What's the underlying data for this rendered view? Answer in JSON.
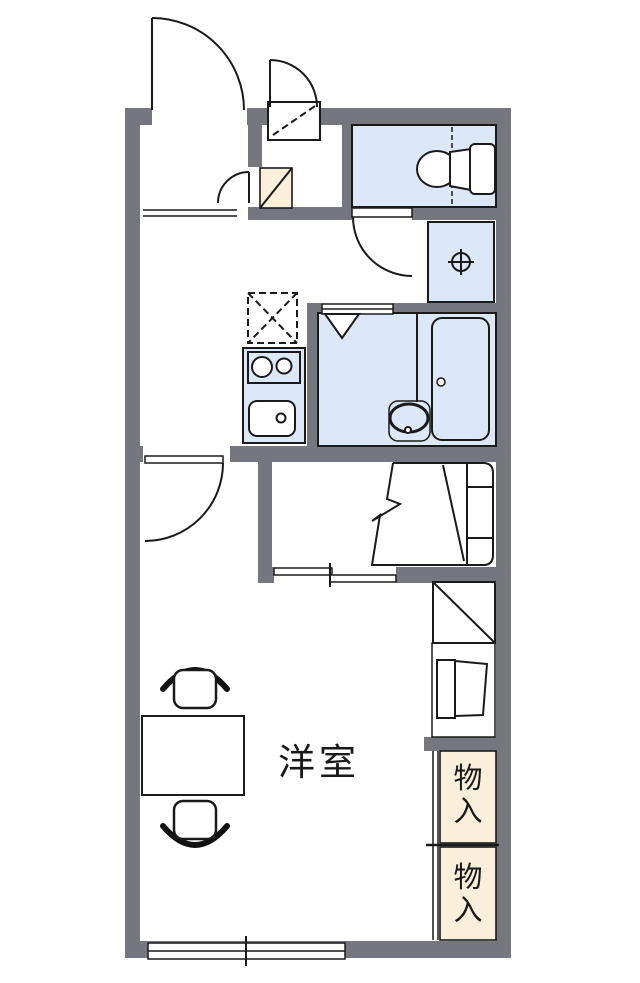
{
  "meta": {
    "type": "japanese-apartment-floor-plan"
  },
  "labels": {
    "western_room": "洋室",
    "storage_upper": "物入",
    "storage_lower": "物入"
  },
  "colors": {
    "wall": "#76767E",
    "wet_area": "#DCE8F7",
    "storage": "#FAEFDB",
    "outline": "#1A1A1A",
    "floor": "#FFFFFF"
  },
  "fixtures": [
    "entrance-door",
    "delivery-locker",
    "delivery-locker-door",
    "shoe-cabinet",
    "shoe-cabinet-door",
    "entrance-step",
    "toilet",
    "toilet-door",
    "washing-machine-space",
    "faucet-symbol",
    "bathroom",
    "bathtub",
    "washbasin",
    "bathroom-folding-door",
    "kitchen-counter",
    "two-burner-stove",
    "kitchen-sink",
    "refrigerator-space",
    "room-door",
    "folding-bed",
    "sliding-door",
    "shelf",
    "tv-stand",
    "storage-closet-upper",
    "storage-closet-lower",
    "table",
    "chair",
    "sliding-window"
  ]
}
